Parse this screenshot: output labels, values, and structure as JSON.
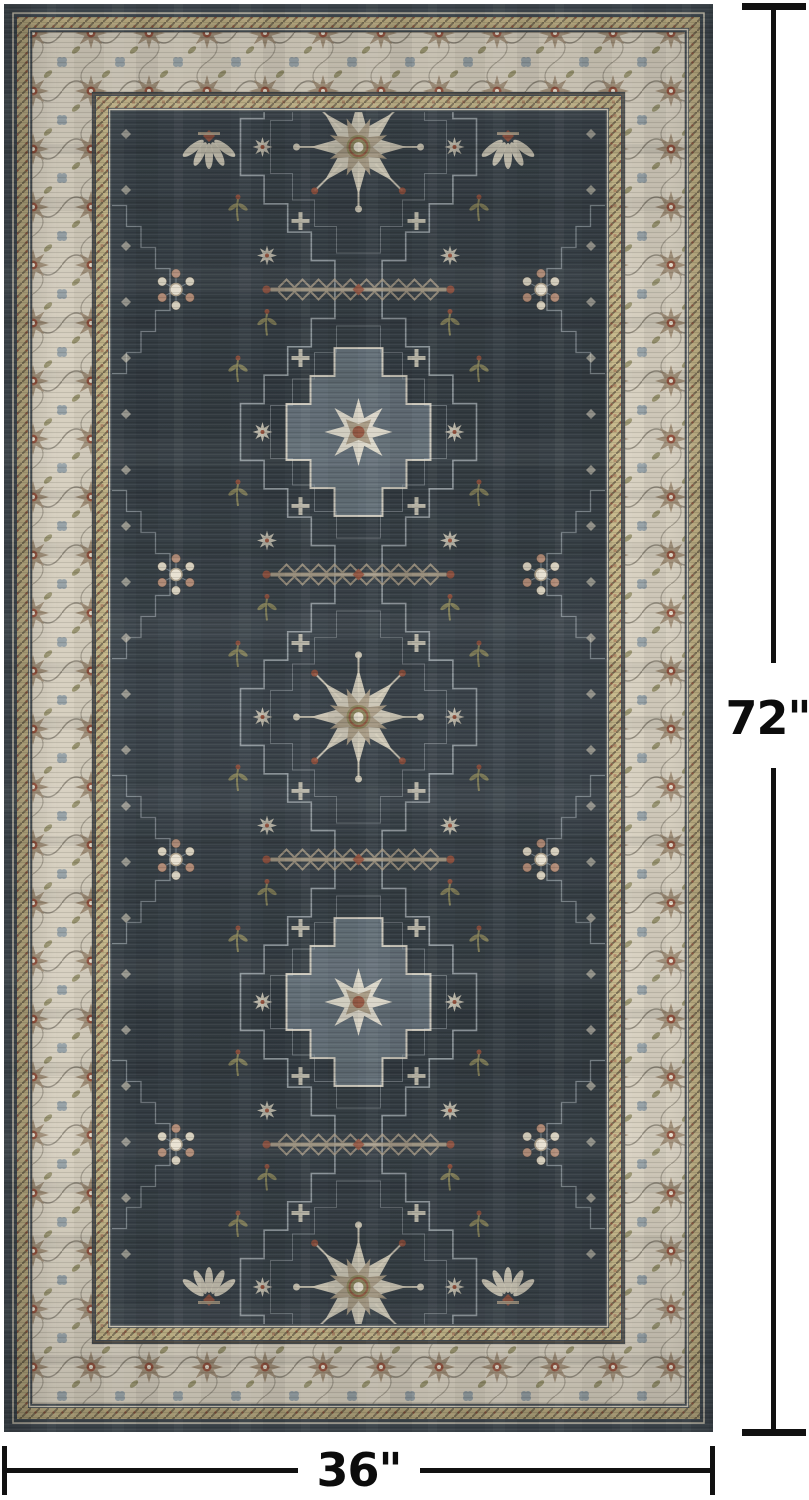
{
  "product": {
    "height_label": "72\"",
    "width_label": "36\""
  },
  "annotation": {
    "line_color": "#111111",
    "text_color": "#0c0c0c"
  },
  "rug": {
    "colors": {
      "edge": "#434c53",
      "field": "#3a434a",
      "field_dark": "#333b41",
      "border_bg": "#d7d0c0",
      "border_motif": "#a08e77",
      "outline_dark": "#5f574b",
      "guard_gold": "#c0b185",
      "guard_gold2": "#c6b88a",
      "guard_dot": "#73684f",
      "cream": "#d6cfbd",
      "ivory": "#e8e1d1",
      "taupe": "#a79a84",
      "rust": "#94523e",
      "olive": "#8b865c",
      "blue_gray": "#8695a0",
      "light_gray": "#b3bcc1"
    }
  }
}
